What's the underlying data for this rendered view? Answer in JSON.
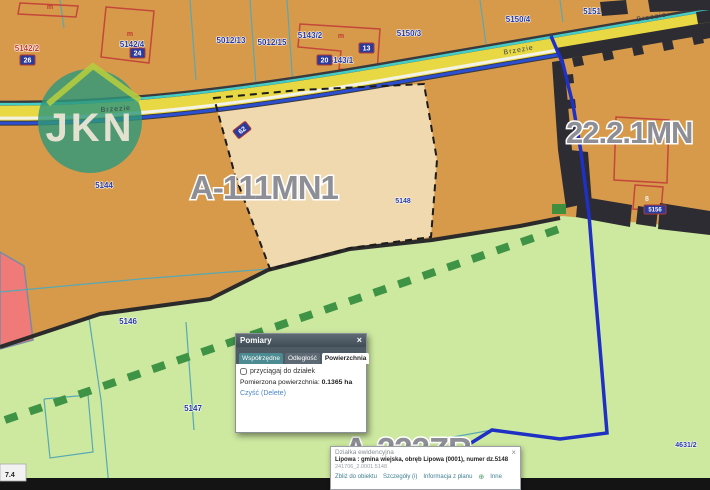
{
  "map": {
    "zones": {
      "a111": "A-111MN1",
      "mn221": "22.2.1MN",
      "a222": "A-222ZR"
    },
    "road_name": "Brzezie",
    "logo": "JKN",
    "corner_readout": "7.4",
    "parcel_numbers": {
      "p5142_2": "5142/2",
      "p5142_4": "5142/4",
      "p5012_13": "5012/13",
      "p5012_15": "5012/15",
      "p5143_2": "5143/2",
      "p5143_1": "5143/1",
      "p5150_3": "5150/3",
      "p5150_4": "5150/4",
      "p5151": "5151",
      "p5144": "5144",
      "p5146": "5146",
      "p5147": "5147",
      "p5148": "5148",
      "p4631_2": "4631/2"
    },
    "badges": {
      "b26": "26",
      "b24": "24",
      "b20": "20",
      "b13": "13",
      "b62": "62",
      "b5156": "5156"
    },
    "marks": {
      "m": "m",
      "house8": "8"
    }
  },
  "measure_dialog": {
    "title": "Pomiary",
    "close": "×",
    "tabs": [
      "Współrzędne",
      "Odległość",
      "Powierzchnia"
    ],
    "snap_label": "przyciągaj do działek",
    "result_label": "Pomierzona powierzchnia:",
    "result_value": "0.1365 ha",
    "clear_link": "Czyść (Delete)"
  },
  "parcel_panel": {
    "title": "Działka ewidencyjna",
    "close": "×",
    "description": "Lipowa : gmina wiejska, obręb Lipowa (0001), numer dz.5148",
    "parcel_id": "241706_2.0001.5148",
    "actions": {
      "zoom_to": "Zbliż do obiektu",
      "details": "Szczegóły (i)",
      "plan_info": "Informacja z planu",
      "more_icon": "⊕",
      "more": "Inne"
    }
  },
  "colors": {
    "zone_orange": "#d79a4b",
    "zone_green": "#cde9a0",
    "zone_pink": "#f07a78",
    "parcel_highlight": "#f0d9ae",
    "road_yellow": "#e8d944",
    "selection_blue": "#1f30c4",
    "label_gray": "#8e8e96",
    "parcel_label_blue": "#23379e"
  }
}
